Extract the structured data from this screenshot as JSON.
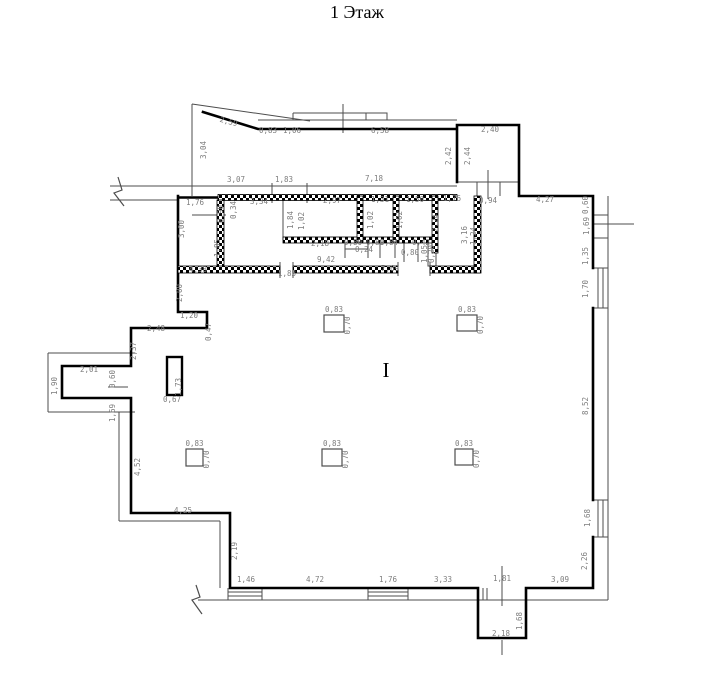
{
  "title": "1 Этаж",
  "colors": {
    "wall": "#000000",
    "thin": "#4d4d4d",
    "dim_text": "#7d7d7d"
  },
  "floorplan": {
    "beam_symbol": {
      "text": "I",
      "x": 386,
      "y": 377
    },
    "columns": [
      {
        "x": 324,
        "y": 315,
        "w": 20,
        "h": 17,
        "label_top": "0,83",
        "label_side": "0,70"
      },
      {
        "x": 457,
        "y": 315,
        "w": 20,
        "h": 16,
        "label_top": "0,83",
        "label_side": "0,70"
      },
      {
        "x": 186,
        "y": 449,
        "w": 17,
        "h": 17,
        "label_top": "0,83",
        "label_side": "0,70"
      },
      {
        "x": 322,
        "y": 449,
        "w": 20,
        "h": 17,
        "label_top": "0,83",
        "label_side": "0,70"
      },
      {
        "x": 455,
        "y": 449,
        "w": 18,
        "h": 16,
        "label_top": "0,83",
        "label_side": "0,70"
      }
    ],
    "pillar": {
      "label_v": "1,73",
      "label_h": "0,67"
    },
    "dim_labels": [
      {
        "t": "2,59",
        "x": 228,
        "y": 124,
        "r": 15
      },
      {
        "t": "3,04",
        "x": 206,
        "y": 150,
        "r": -90
      },
      {
        "t": "0,83",
        "x": 268,
        "y": 133,
        "r": 0
      },
      {
        "t": "1,06",
        "x": 292,
        "y": 133,
        "r": 0
      },
      {
        "t": "6,58",
        "x": 380,
        "y": 133,
        "r": 0
      },
      {
        "t": "2,40",
        "x": 490,
        "y": 132,
        "r": 0
      },
      {
        "t": "2,42",
        "x": 451,
        "y": 156,
        "r": -90
      },
      {
        "t": "2,44",
        "x": 470,
        "y": 156,
        "r": -90
      },
      {
        "t": "3,07",
        "x": 236,
        "y": 182,
        "r": 0
      },
      {
        "t": "1,83",
        "x": 284,
        "y": 182,
        "r": 0
      },
      {
        "t": "7,18",
        "x": 374,
        "y": 181,
        "r": 0
      },
      {
        "t": "1,76",
        "x": 195,
        "y": 205,
        "r": 0
      },
      {
        "t": "0,34",
        "x": 236,
        "y": 210,
        "r": -90
      },
      {
        "t": "3,34",
        "x": 259,
        "y": 204,
        "r": 0
      },
      {
        "t": "2,97",
        "x": 332,
        "y": 203,
        "r": 0
      },
      {
        "t": "1,31",
        "x": 380,
        "y": 202,
        "r": 0
      },
      {
        "t": "1,50",
        "x": 415,
        "y": 202,
        "r": 0
      },
      {
        "t": "1,76",
        "x": 452,
        "y": 201,
        "r": 0
      },
      {
        "t": "0,94",
        "x": 488,
        "y": 203,
        "r": 0
      },
      {
        "t": "4,27",
        "x": 545,
        "y": 202,
        "r": 0
      },
      {
        "t": "0,60",
        "x": 588,
        "y": 205,
        "r": -90
      },
      {
        "t": "1,69",
        "x": 589,
        "y": 226,
        "r": -90
      },
      {
        "t": "1,35",
        "x": 588,
        "y": 256,
        "r": -90
      },
      {
        "t": "1,70",
        "x": 588,
        "y": 289,
        "r": -90
      },
      {
        "t": "8,52",
        "x": 588,
        "y": 406,
        "r": -90
      },
      {
        "t": "1,68",
        "x": 590,
        "y": 518,
        "r": -90
      },
      {
        "t": "2,26",
        "x": 587,
        "y": 561,
        "r": -90
      },
      {
        "t": "3,00",
        "x": 184,
        "y": 229,
        "r": -90
      },
      {
        "t": "0,90",
        "x": 223,
        "y": 214,
        "r": -90
      },
      {
        "t": "1,85",
        "x": 220,
        "y": 248,
        "r": -90
      },
      {
        "t": "1,84",
        "x": 293,
        "y": 220,
        "r": -90
      },
      {
        "t": "1,02",
        "x": 304,
        "y": 221,
        "r": -90
      },
      {
        "t": "1,02",
        "x": 373,
        "y": 220,
        "r": -90
      },
      {
        "t": "1,02",
        "x": 402,
        "y": 220,
        "r": -90
      },
      {
        "t": "2,24",
        "x": 438,
        "y": 223,
        "r": -90
      },
      {
        "t": "3,16",
        "x": 467,
        "y": 235,
        "r": -90
      },
      {
        "t": "1,24",
        "x": 476,
        "y": 236,
        "r": -90
      },
      {
        "t": "2,18",
        "x": 320,
        "y": 246,
        "r": 0
      },
      {
        "t": "0,80",
        "x": 353,
        "y": 245,
        "r": 0
      },
      {
        "t": "0,80",
        "x": 375,
        "y": 245,
        "r": 0
      },
      {
        "t": "0,84",
        "x": 389,
        "y": 245,
        "r": 0
      },
      {
        "t": "0,42",
        "x": 421,
        "y": 245,
        "r": 0
      },
      {
        "t": "0,24",
        "x": 364,
        "y": 252,
        "r": 0
      },
      {
        "t": "0,80",
        "x": 410,
        "y": 255,
        "r": 0
      },
      {
        "t": "1,05",
        "x": 427,
        "y": 254,
        "r": -90
      },
      {
        "t": "0,20",
        "x": 434,
        "y": 254,
        "r": -90
      },
      {
        "t": "9,42",
        "x": 326,
        "y": 262,
        "r": 0
      },
      {
        "t": "4,38",
        "x": 198,
        "y": 272,
        "r": 0
      },
      {
        "t": "1,83",
        "x": 287,
        "y": 276,
        "r": 0
      },
      {
        "t": "7,69",
        "x": 390,
        "y": 271,
        "r": 0
      },
      {
        "t": "2,00",
        "x": 182,
        "y": 293,
        "r": -90
      },
      {
        "t": "1,20",
        "x": 189,
        "y": 318,
        "r": 0
      },
      {
        "t": "0,47",
        "x": 211,
        "y": 332,
        "r": -90
      },
      {
        "t": "2,48",
        "x": 156,
        "y": 331,
        "r": 0
      },
      {
        "t": "2,37",
        "x": 136,
        "y": 351,
        "r": -90
      },
      {
        "t": "2,01",
        "x": 89,
        "y": 372,
        "r": 0
      },
      {
        "t": "1,90",
        "x": 57,
        "y": 386,
        "r": -90
      },
      {
        "t": "0,60",
        "x": 115,
        "y": 379,
        "r": -90
      },
      {
        "t": "1,69",
        "x": 115,
        "y": 413,
        "r": -90
      },
      {
        "t": "0,67",
        "x": 172,
        "y": 402,
        "r": 0
      },
      {
        "t": "4,52",
        "x": 140,
        "y": 467,
        "r": -90
      },
      {
        "t": "4,25",
        "x": 183,
        "y": 513,
        "r": 0
      },
      {
        "t": "2,19",
        "x": 237,
        "y": 551,
        "r": -90
      },
      {
        "t": "1,46",
        "x": 246,
        "y": 582,
        "r": 0
      },
      {
        "t": "4,72",
        "x": 315,
        "y": 582,
        "r": 0
      },
      {
        "t": "1,76",
        "x": 388,
        "y": 582,
        "r": 0
      },
      {
        "t": "3,33",
        "x": 443,
        "y": 582,
        "r": 0
      },
      {
        "t": "1,81",
        "x": 502,
        "y": 581,
        "r": 0
      },
      {
        "t": "3,09",
        "x": 560,
        "y": 582,
        "r": 0
      },
      {
        "t": "2,18",
        "x": 501,
        "y": 636,
        "r": 0
      },
      {
        "t": "1,68",
        "x": 522,
        "y": 621,
        "r": -90
      }
    ]
  }
}
